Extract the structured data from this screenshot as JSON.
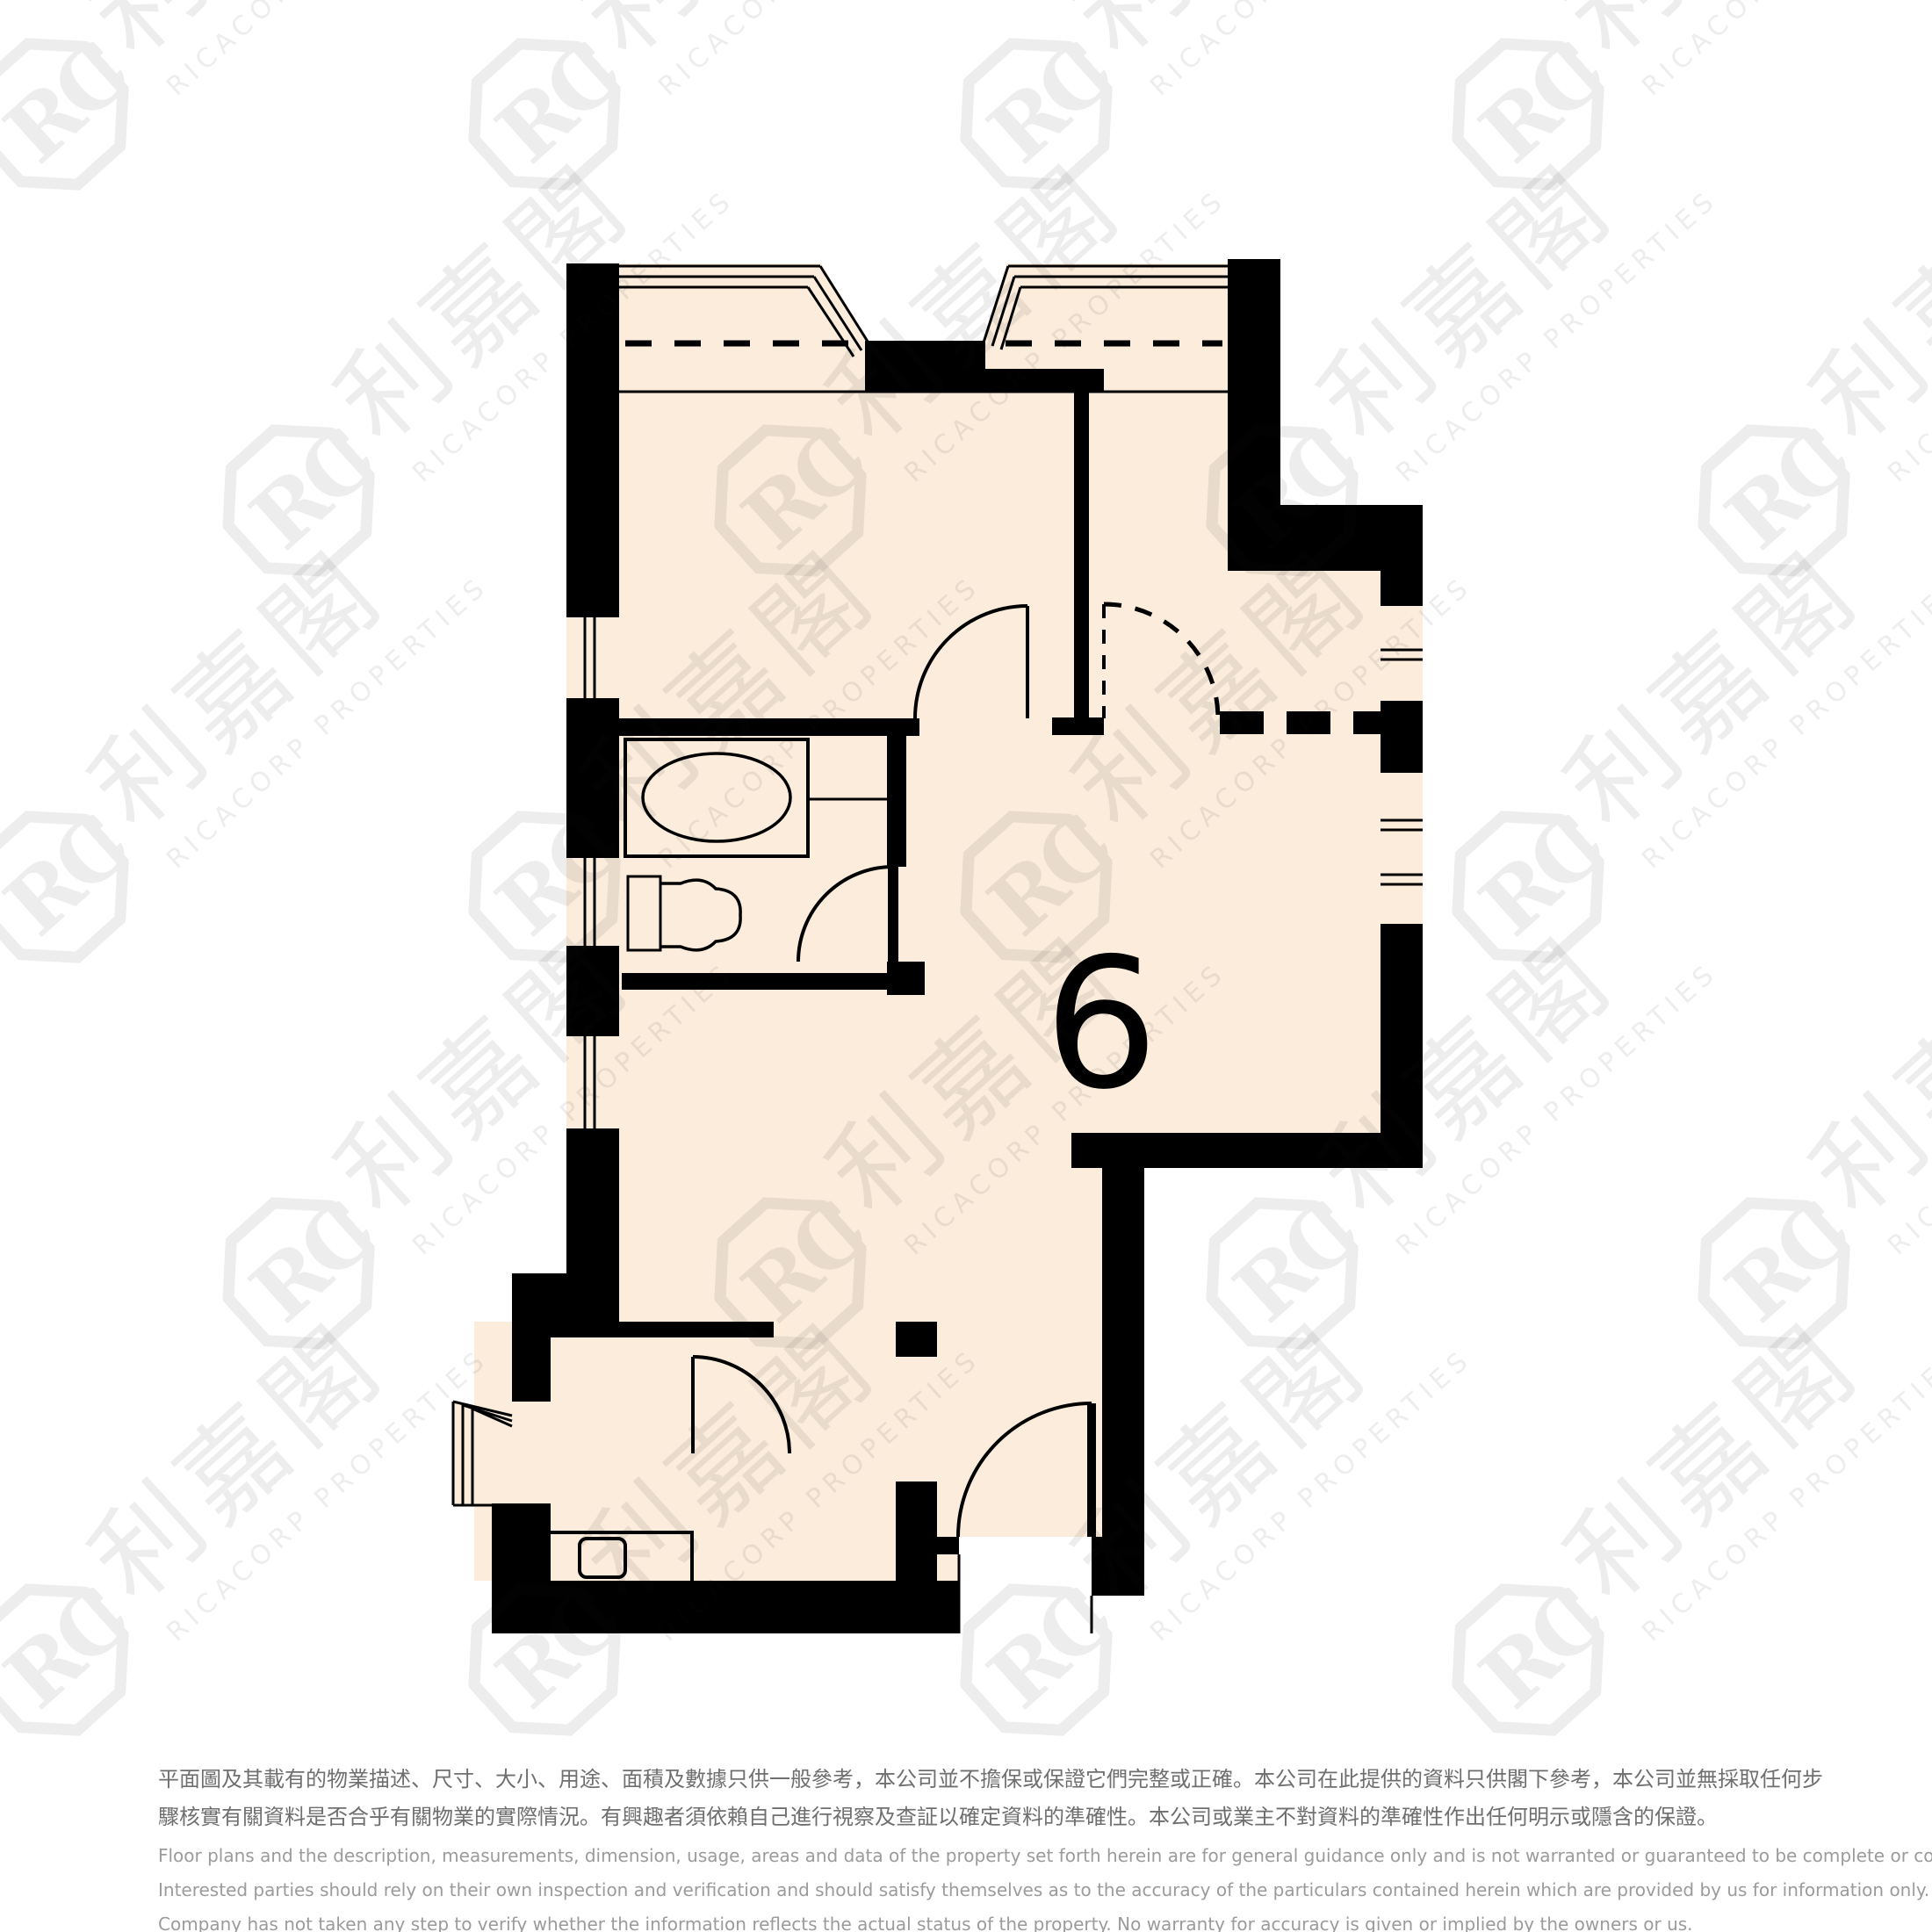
{
  "floor_plan": {
    "unit_number": "6",
    "wall_color": "#000000",
    "room_fill": "#fbecdc"
  },
  "watermark": {
    "monogram": "RC",
    "cjk": "利嘉閣",
    "latin": "RICACORP PROPERTIES",
    "color": "#e6e6e6"
  },
  "disclaimer": {
    "zh": [
      "平面圖及其載有的物業描述、尺寸、大小、用途、面積及數據只供一般參考，本公司並不擔保或保證它們完整或正確。本公司在此提供的資料只供閣下參考，本公司並無採取任何步",
      "驟核實有關資料是否合乎有關物業的實際情況。有興趣者須依賴自己進行視察及查証以確定資料的準確性。本公司或業主不對資料的準確性作出任何明示或隱含的保證。"
    ],
    "en": [
      "Floor plans and the description, measurements, dimension, usage, areas and data of the property set forth herein are for general guidance only and is not warranted or guaranteed to be complete or correct.",
      "Interested parties should rely on their own inspection and verification and should satisfy themselves as to the accuracy of the particulars contained herein which are provided by us for information only.  Our",
      "Company has not taken any step to verify whether the information reflects the actual status of the property.  No warranty for accuracy is given or implied by the owners or us."
    ]
  }
}
